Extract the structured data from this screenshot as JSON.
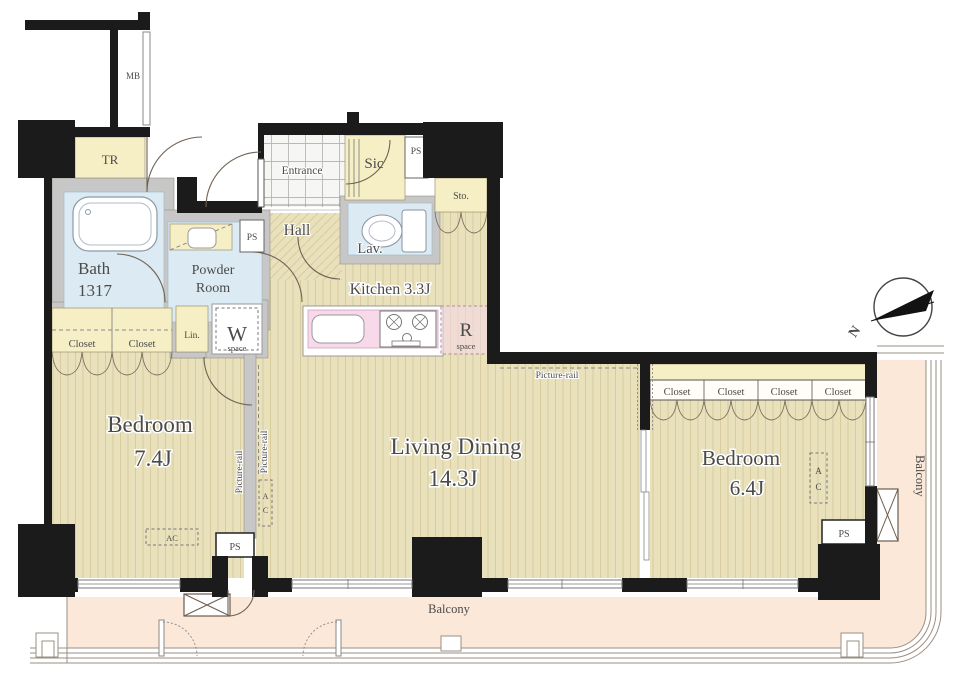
{
  "rooms": {
    "bedroom1": {
      "name": "Bedroom",
      "size": "7.4J"
    },
    "living_dining": {
      "name": "Living Dining",
      "size": "14.3J"
    },
    "bedroom2": {
      "name": "Bedroom",
      "size": "6.4J"
    },
    "kitchen": {
      "label": "Kitchen 3.3J"
    },
    "bath": {
      "name": "Bath",
      "size": "1317"
    },
    "powder_room": {
      "line1": "Powder",
      "line2": "Room"
    },
    "entrance": {
      "label": "Entrance"
    },
    "hall": {
      "label": "Hall"
    },
    "lavatory": {
      "label": "Lav."
    },
    "shoe_closet": {
      "label": "Sic"
    },
    "storage": {
      "label": "Sto."
    },
    "trunk_room": {
      "label": "TR"
    },
    "linen": {
      "label": "Lin."
    },
    "meter_box": {
      "label": "MB"
    }
  },
  "fixtures": {
    "closet": "Closet",
    "washer_letter": "W",
    "fridge_letter": "R",
    "space": "space",
    "pipe_space": "PS",
    "ac": "AC",
    "ac_a": "A",
    "ac_c": "C"
  },
  "annotations": {
    "picture_rail": "Picture-rail",
    "balcony": "Balcony",
    "north": "N"
  },
  "colors": {
    "wall": "#1b1b1b",
    "wood": "#e9e0bc",
    "wood_stripe": "#d8cc9f",
    "yellow": "#f6efc5",
    "blue": "#dcebf3",
    "pink": "#f8d9e9",
    "balcony": "#fbe8d9",
    "gray": "#c7c7c7",
    "text": "#4a4a4a"
  }
}
